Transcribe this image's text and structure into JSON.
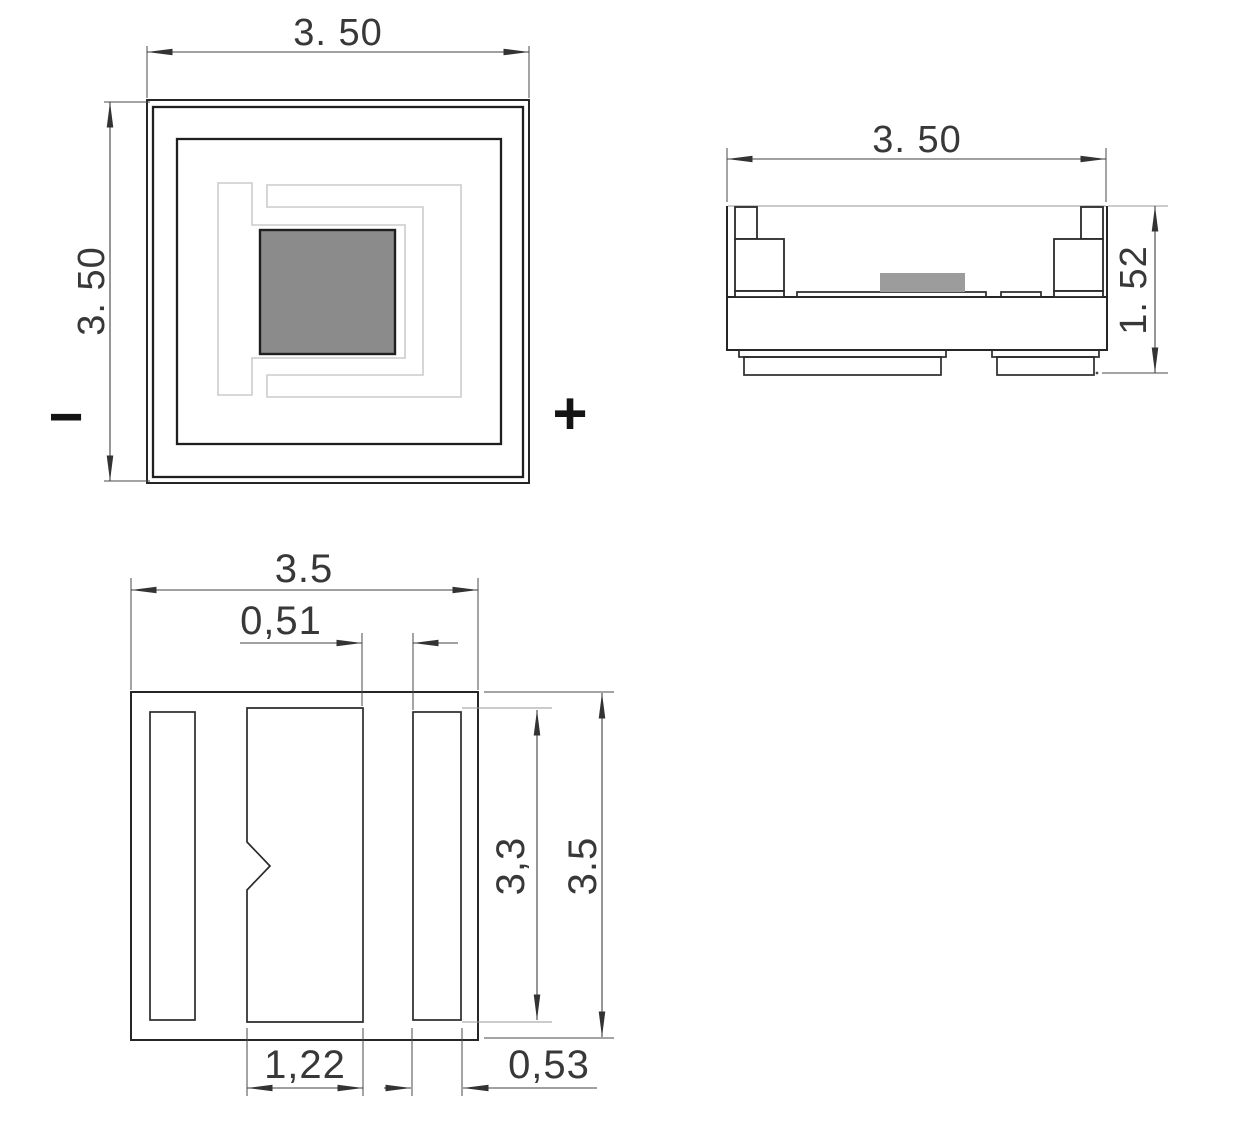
{
  "views": {
    "top": {
      "width_label": "3. 50",
      "height_label": "3. 50",
      "negative_label": "−",
      "positive_label": "+"
    },
    "side": {
      "width_label": "3. 50",
      "height_label": "1. 52"
    },
    "pad_layout": {
      "overall_width_label": "3.5",
      "gap_label": "0,51",
      "pad_height_label": "3,3",
      "overall_height_label": "3.5",
      "center_pad_width_label": "1,22",
      "side_pad_width_label": "0,53"
    }
  },
  "colors": {
    "background": "#ffffff",
    "object_line": "#262626",
    "dimension_line": "#404040",
    "trace": "#cbcbcb",
    "die_fill": "#8b8b8b",
    "side_die_fill": "#9c9c9c"
  }
}
